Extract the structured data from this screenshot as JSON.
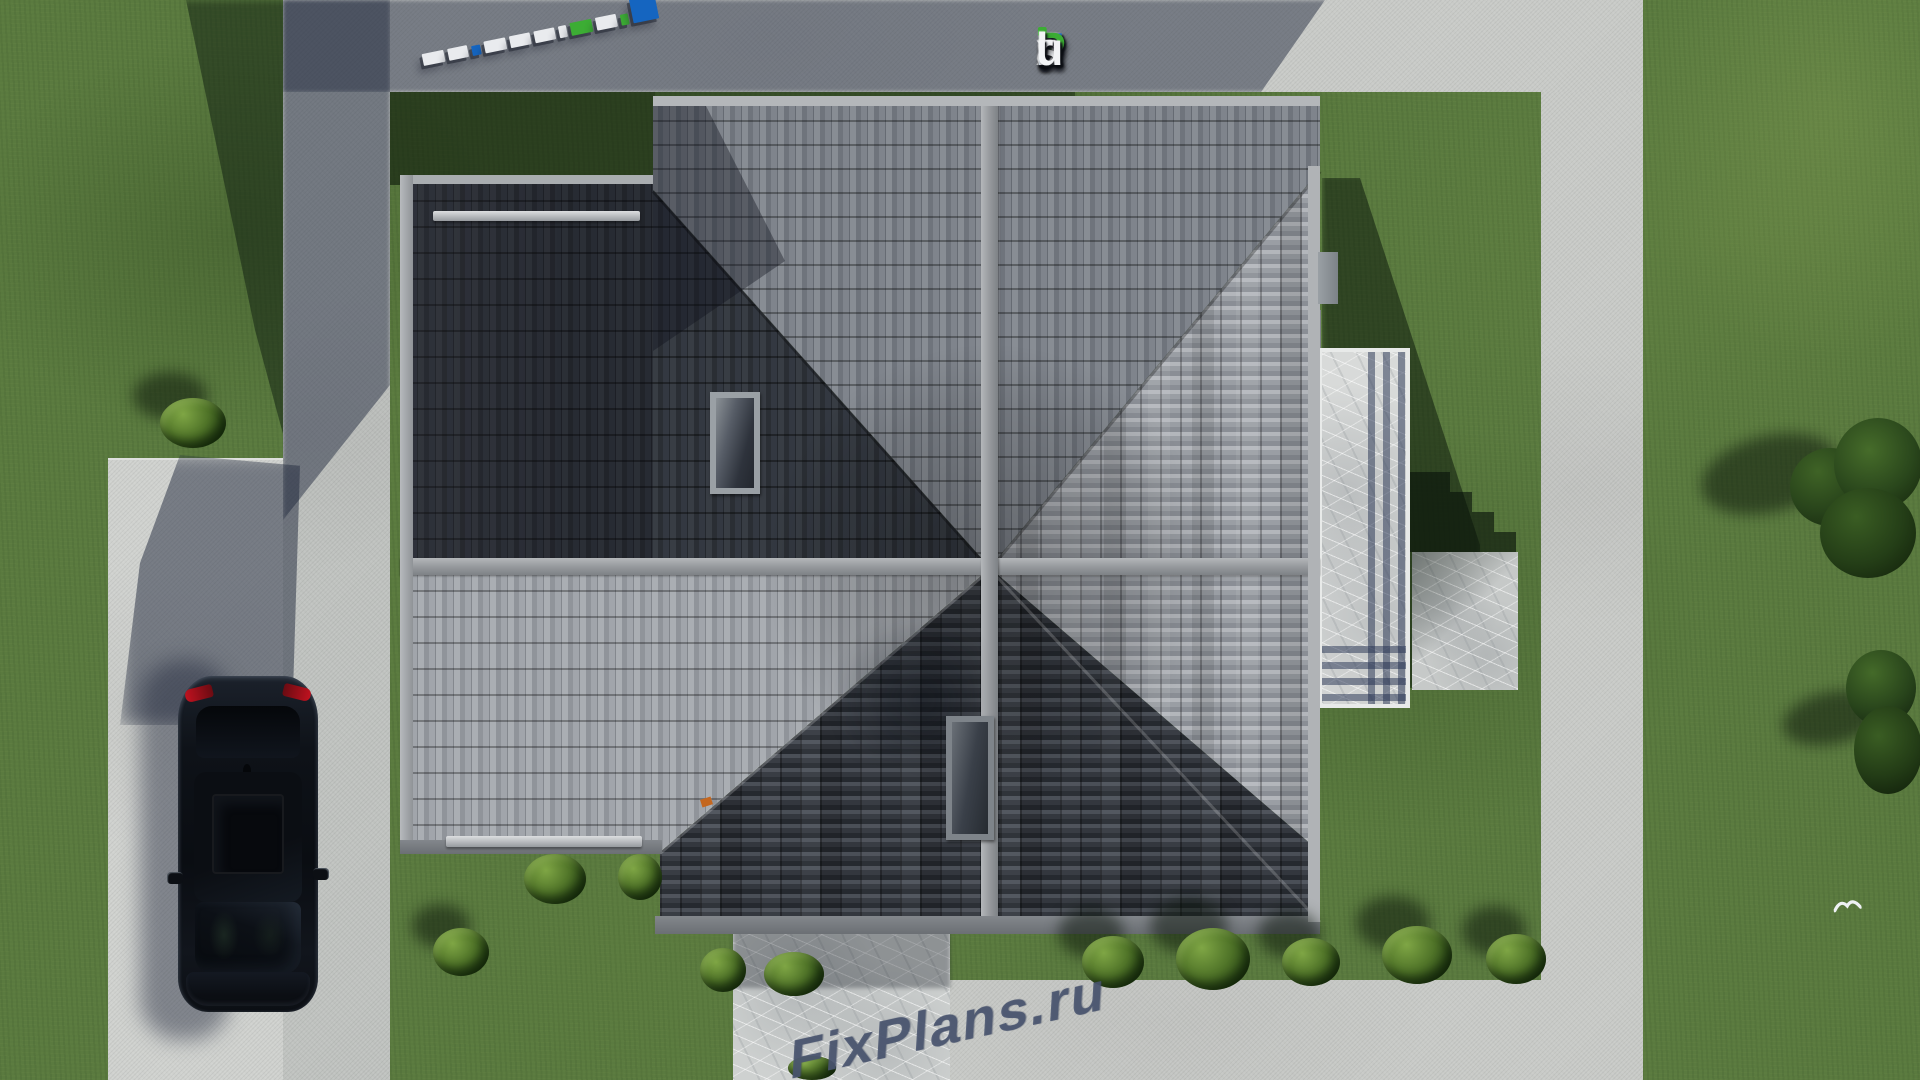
{
  "brand": {
    "logo_text": "FixPlans.ru",
    "watermark_text": "FixPlans.ru",
    "logo_letters": [
      {
        "ch": "F",
        "color": "#1a6fd6"
      },
      {
        "ch": "ı",
        "color": "#f2f4f6",
        "dot": "#3cad34"
      },
      {
        "ch": "x",
        "color": "#f2f4f6"
      },
      {
        "ch": "P",
        "color": "#3cad34"
      },
      {
        "ch": "l",
        "color": "#f2f4f6"
      },
      {
        "ch": "a",
        "color": "#f2f4f6"
      },
      {
        "ch": "n",
        "color": "#f2f4f6"
      },
      {
        "ch": "s",
        "color": "#f2f4f6"
      },
      {
        "ch": ".",
        "color": "#1a6fd6"
      },
      {
        "ch": "r",
        "color": "#f2f4f6"
      },
      {
        "ch": "u",
        "color": "#f2f4f6"
      }
    ],
    "watermark_top_letters": [
      {
        "ch": "F",
        "color": "#f3f5f6"
      },
      {
        "ch": "i",
        "color": "#f3f5f6"
      },
      {
        "ch": "x",
        "color": "#f3f5f6"
      },
      {
        "ch": "P",
        "color": "#3cad34"
      },
      {
        "ch": "l",
        "color": "#f3f5f6"
      },
      {
        "ch": "a",
        "color": "#f3f5f6"
      },
      {
        "ch": "n",
        "color": "#f3f5f6"
      },
      {
        "ch": "s",
        "color": "#f3f5f6"
      },
      {
        "ch": ".",
        "color": "#1e78d8"
      },
      {
        "ch": "r",
        "color": "#f3f5f6"
      },
      {
        "ch": "u",
        "color": "#f3f5f6"
      }
    ],
    "strip_blocks": [
      {
        "w": 22,
        "h": 12,
        "color": "#e9ebee"
      },
      {
        "w": 20,
        "h": 12,
        "color": "#e9ebee"
      },
      {
        "w": 9,
        "h": 10,
        "color": "#1565c0"
      },
      {
        "w": 22,
        "h": 12,
        "color": "#e9ebee"
      },
      {
        "w": 21,
        "h": 12,
        "color": "#e9ebee"
      },
      {
        "w": 21,
        "h": 12,
        "color": "#e9ebee"
      },
      {
        "w": 8,
        "h": 12,
        "color": "#e9ebee"
      },
      {
        "w": 22,
        "h": 13,
        "color": "#3cad34"
      },
      {
        "w": 21,
        "h": 13,
        "color": "#e9ebee"
      },
      {
        "w": 8,
        "h": 11,
        "color": "#3cad34"
      },
      {
        "w": 26,
        "h": 24,
        "color": "#1565c0"
      }
    ]
  },
  "colors": {
    "lawn": "#5a7a3f",
    "lawn_shadow": "#24361b",
    "concrete_light": "#c8cac7",
    "concrete_shadow": "#6e737d",
    "roof_dark": "#32363c",
    "roof_light": "#a3a7ac",
    "roof_medium": "#7b8088",
    "ridge": "#a8abaf",
    "marble": "#ced1d0",
    "car_body": "#0d1117",
    "logo_blue": "#1a6fd6",
    "logo_green": "#3cad34",
    "logo_white": "#f2f4f6",
    "watermark_extrusion": "#49546e"
  }
}
